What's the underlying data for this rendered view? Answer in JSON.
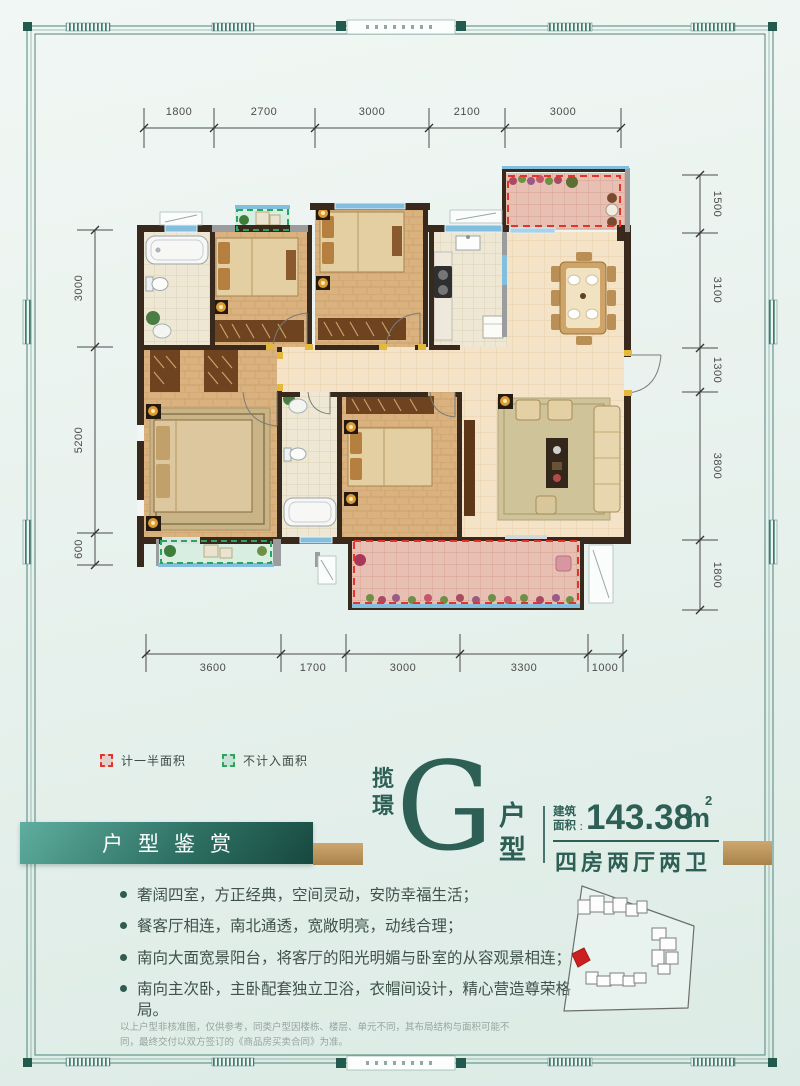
{
  "legend": {
    "items": [
      {
        "label": "计一半面积",
        "color": "#e23428"
      },
      {
        "label": "不计入面积",
        "color": "#2aa45e"
      }
    ]
  },
  "plan": {
    "dims": {
      "top": [
        "1800",
        "2700",
        "3000",
        "2100",
        "3000"
      ],
      "bottom": [
        "3600",
        "1700",
        "3000",
        "3300",
        "1000"
      ],
      "left": [
        "3000",
        "5200",
        "600"
      ],
      "right": [
        "1500",
        "3100",
        "1300",
        "3800",
        "1800"
      ]
    }
  },
  "banner": {
    "label": "户型鉴赏"
  },
  "title": {
    "project": "揽璟",
    "type_letter": "G",
    "type_word": "户型",
    "area_label": "建筑面积",
    "area_colon": "：",
    "area_value": "143.38",
    "area_unit_base": "m",
    "area_unit_sup": "2",
    "layout": "四房两厅两卫"
  },
  "highlights": [
    "奢阔四室，方正经典，空间灵动，安防幸福生活；",
    "餐客厅相连，南北通透，宽敞明亮，动线合理；",
    "南向大面宽景阳台，将客厅的阳光明媚与卧室的从容观景相连；",
    "南向主次卧，主卧配套独立卫浴，衣帽间设计，精心营造尊荣格局。"
  ],
  "disclaimer": "以上户型非核准图，仅供参考，同类户型因楼栋、楼层、单元不同，其布局结构与面积可能不同，最终交付以双方签订的《商品房买卖合同》为准。",
  "colors": {
    "accent_teal": "#2d5f55",
    "banner_teal_dark": "#17483f",
    "gold": "#b98f55",
    "legend_red": "#e23428",
    "legend_green": "#2aa45e",
    "wall": "#39291d",
    "balcony_pink": "#e7bfb2",
    "balcony_green": "#d8eee1"
  }
}
